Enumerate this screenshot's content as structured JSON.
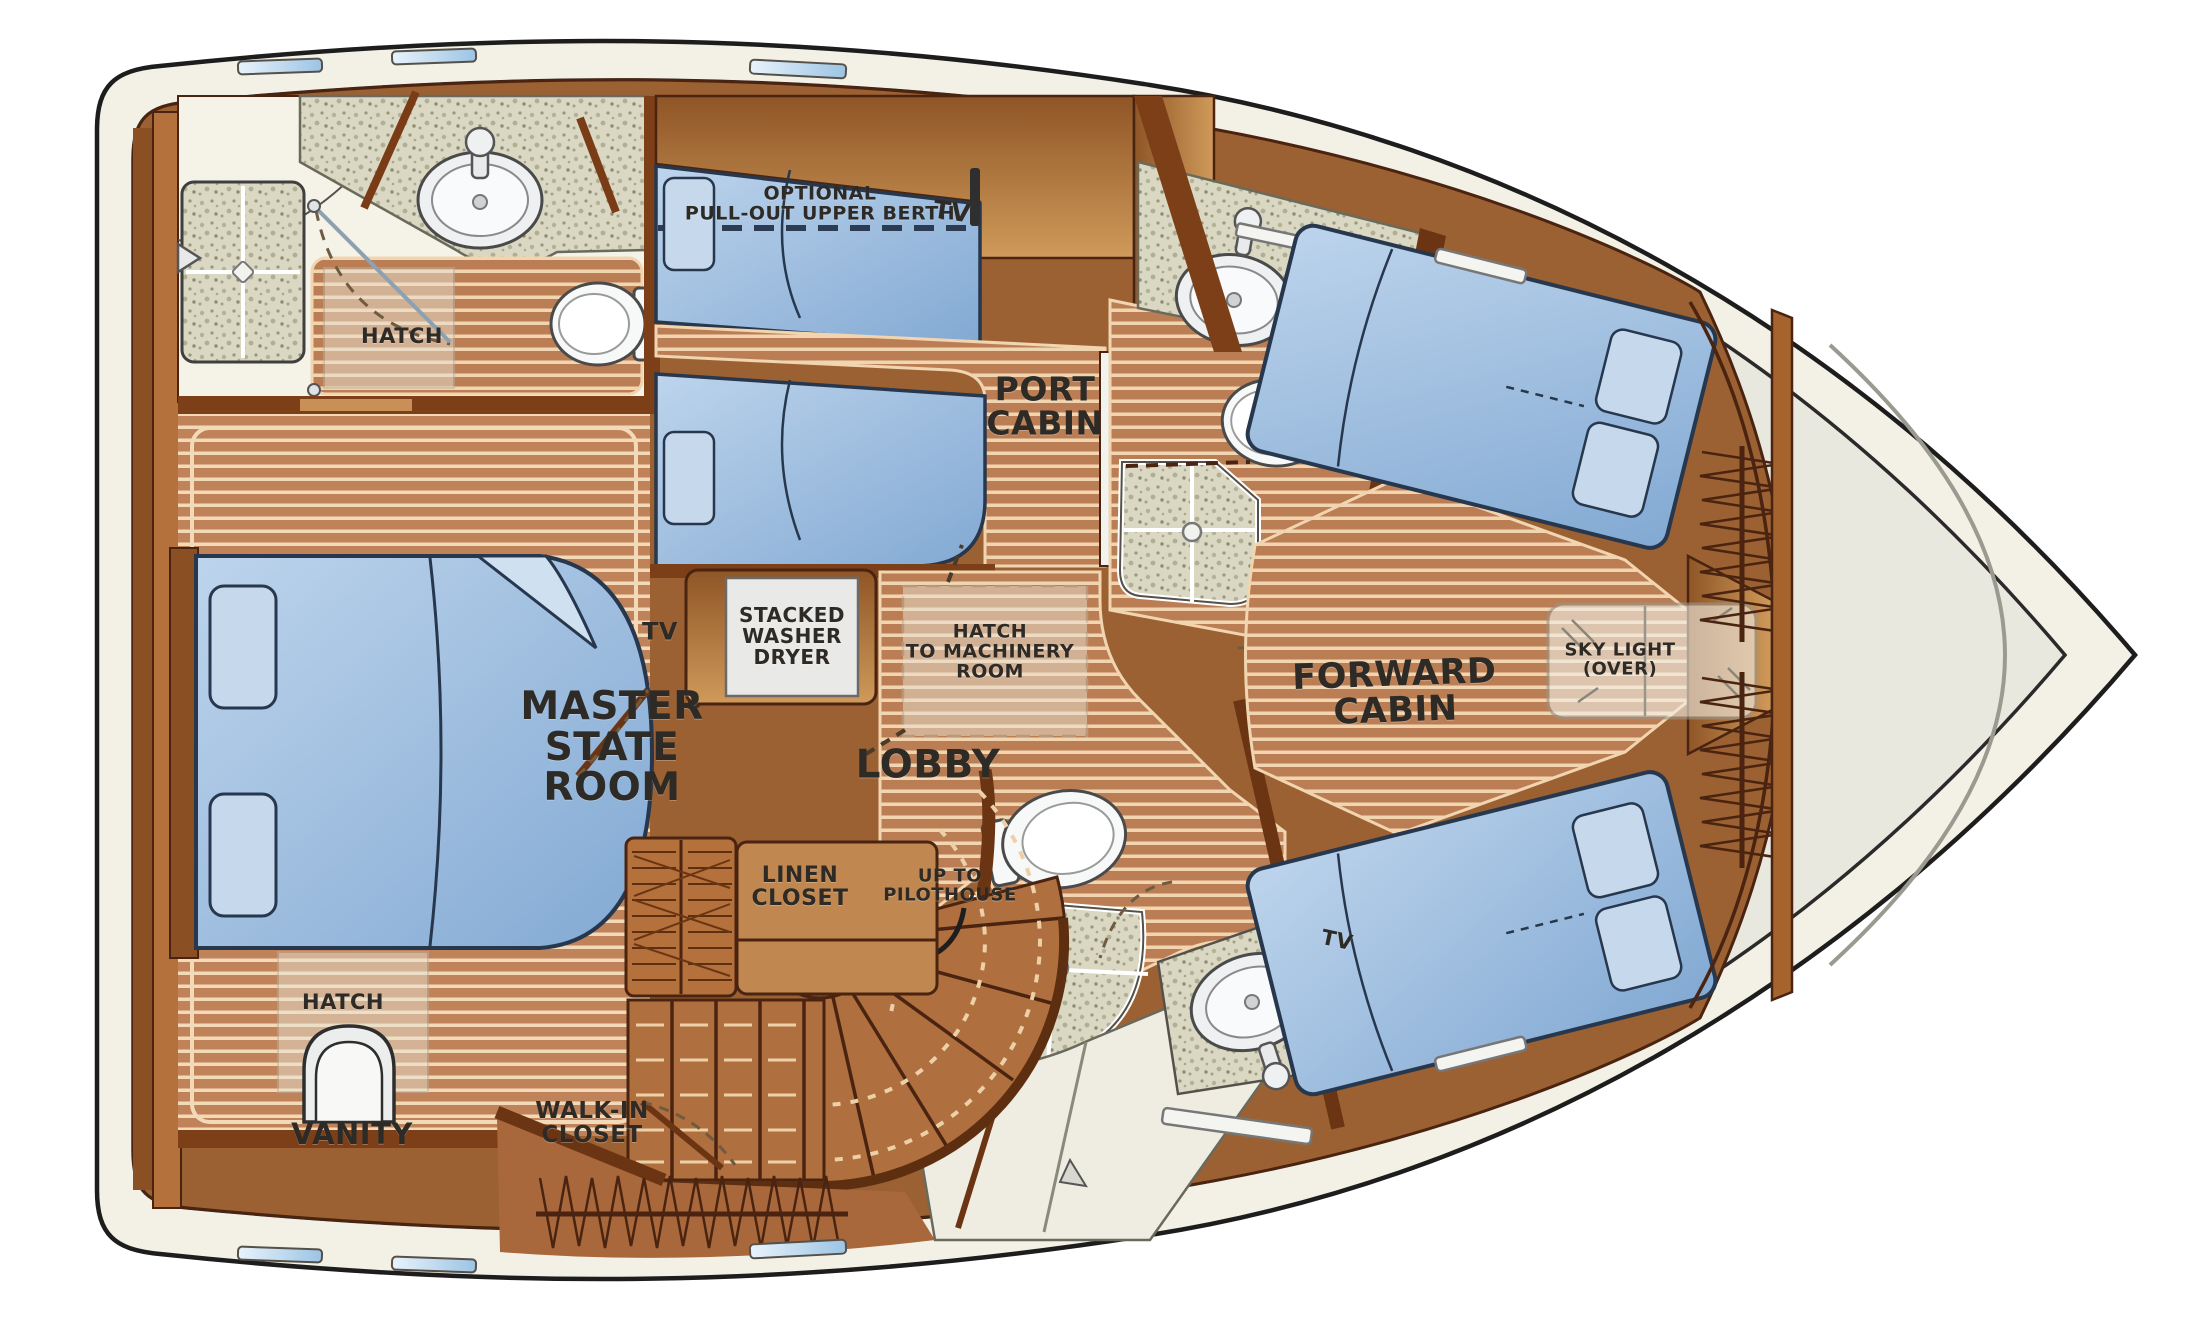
{
  "title": "Yacht lower accommodations deck floor plan",
  "rooms": {
    "master_state_room": "MASTER\nSTATE\nROOM",
    "lobby": "LOBBY",
    "port_cabin": "PORT\nCABIN",
    "forward_cabin": "FORWARD\nCABIN"
  },
  "labels": {
    "hatch_master_head": "HATCH",
    "optional_pullout_berth": "OPTIONAL\nPULL-OUT UPPER BERTH",
    "tv_port_cabin": "TV",
    "tv_master": "TV",
    "stacked_washer_dryer": "STACKED\nWASHER\nDRYER",
    "hatch_to_machinery": "HATCH\nTO MACHINERY\nROOM",
    "sky_light": "SKY LIGHT\n(OVER)",
    "linen_closet": "LINEN\nCLOSET",
    "up_to_pilothouse": "UP TO\nPILOTHOUSE",
    "hatch_vanity": "HATCH",
    "vanity": "VANITY",
    "walk_in_closet": "WALK-IN\nCLOSET",
    "tv_forward": "TV"
  },
  "colors": {
    "hull_band": "#f3f1e5",
    "deck": "#e8e8de",
    "interior_base": "#9c6132",
    "teak_base": "#bb7e54",
    "teak_line": "#f0d5b0",
    "wall_dark": "#6b3514",
    "cabinet_light": "#cf9a5a",
    "bed_blue": "#9cbcde",
    "granite": "#dad7c3",
    "fixture_white": "#f7f8f8",
    "outline": "#1d1d1d"
  }
}
